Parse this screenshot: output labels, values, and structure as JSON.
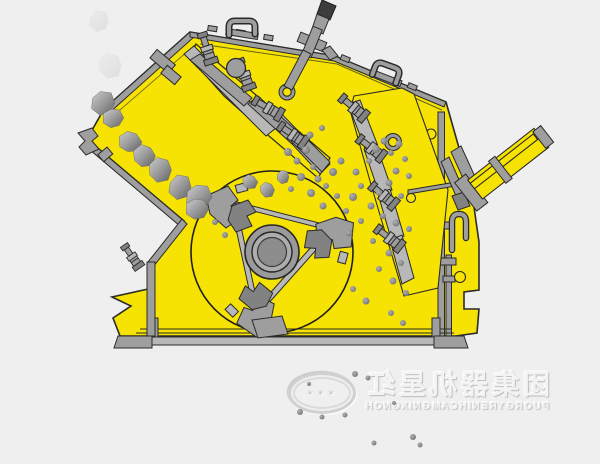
{
  "colors": {
    "bg": "#EFEFEF",
    "body": "#F6E303",
    "outline": "#2A2A2A",
    "steel": "#9E9E9E",
    "steel_light": "#B8B8B8",
    "steel_dark": "#828282",
    "rock_light": "#CDCDCD",
    "rock_dark": "#636363",
    "watermark_text": "#F4F4F4",
    "watermark_shadow": "#BDBDBD"
  },
  "watermark": {
    "chinese": "红星机器集团",
    "english": "HONGXING MACHINERY GROUP",
    "seal_marks": "✶✶✶"
  },
  "rocks": [
    [
      103,
      103,
      13
    ],
    [
      113,
      118,
      11
    ],
    [
      130,
      142,
      12
    ],
    [
      144,
      156,
      12
    ],
    [
      160,
      170,
      13
    ],
    [
      180,
      187,
      13
    ],
    [
      199,
      197,
      14
    ],
    [
      197,
      209,
      12
    ],
    [
      250,
      182,
      8
    ],
    [
      267,
      190,
      8
    ],
    [
      283,
      177,
      7
    ]
  ],
  "ghost_rocks": [
    [
      110,
      66,
      13
    ],
    [
      99,
      21,
      11
    ]
  ],
  "particles": [
    [
      288,
      152,
      4
    ],
    [
      297,
      161,
      3.5
    ],
    [
      306,
      150,
      4
    ],
    [
      313,
      167,
      3
    ],
    [
      301,
      177,
      4
    ],
    [
      318,
      179,
      3.5
    ],
    [
      291,
      189,
      3
    ],
    [
      311,
      193,
      4
    ],
    [
      326,
      186,
      3
    ],
    [
      333,
      172,
      4
    ],
    [
      341,
      161,
      3.5
    ],
    [
      337,
      196,
      3
    ],
    [
      323,
      206,
      3.5
    ],
    [
      346,
      211,
      3
    ],
    [
      353,
      197,
      4
    ],
    [
      361,
      186,
      3
    ],
    [
      356,
      172,
      3.5
    ],
    [
      369,
      161,
      3
    ],
    [
      376,
      149,
      4
    ],
    [
      384,
      141,
      3.5
    ],
    [
      391,
      153,
      3
    ],
    [
      399,
      144,
      3.5
    ],
    [
      405,
      159,
      3
    ],
    [
      396,
      171,
      3.5
    ],
    [
      409,
      176,
      3
    ],
    [
      389,
      183,
      3.5
    ],
    [
      379,
      193,
      3
    ],
    [
      401,
      196,
      3
    ],
    [
      371,
      206,
      3.5
    ],
    [
      383,
      216,
      3
    ],
    [
      396,
      223,
      3.5
    ],
    [
      409,
      229,
      3
    ],
    [
      361,
      221,
      3
    ],
    [
      349,
      233,
      3.5
    ],
    [
      373,
      241,
      3
    ],
    [
      389,
      253,
      3.5
    ],
    [
      401,
      263,
      3
    ],
    [
      379,
      269,
      3
    ],
    [
      393,
      281,
      3.5
    ],
    [
      406,
      293,
      3
    ],
    [
      353,
      289,
      3
    ],
    [
      366,
      301,
      3.5
    ],
    [
      391,
      313,
      3
    ],
    [
      403,
      323,
      3
    ],
    [
      310,
      135,
      3.5
    ],
    [
      322,
      128,
      3
    ],
    [
      215,
      222,
      3
    ],
    [
      225,
      235,
      3
    ]
  ],
  "debris": [
    [
      355,
      374,
      3
    ],
    [
      368,
      378,
      2.5
    ],
    [
      300,
      412,
      3
    ],
    [
      322,
      417,
      2.5
    ],
    [
      345,
      415,
      2.5
    ],
    [
      309,
      384,
      2
    ],
    [
      413,
      437,
      3
    ],
    [
      420,
      445,
      2.5
    ],
    [
      374,
      443,
      2.5
    ],
    [
      394,
      403,
      2
    ]
  ]
}
